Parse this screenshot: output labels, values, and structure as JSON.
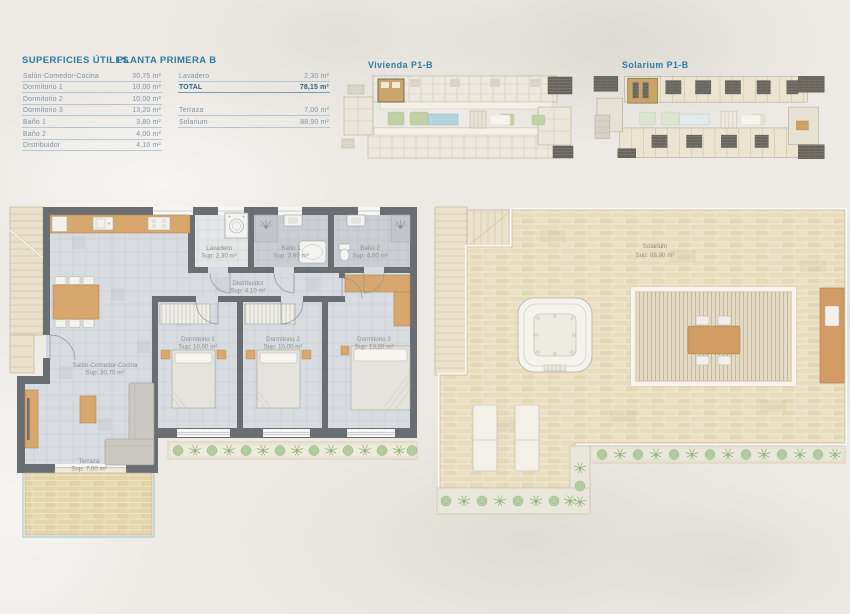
{
  "header": {
    "superficies_title": "SUPERFICIES ÚTILES",
    "planta_title": "PLANTA PRIMERA B"
  },
  "tables": {
    "left": {
      "rows": [
        {
          "label": "Salón-Comedor-Cocina",
          "value": "30,75 m²"
        },
        {
          "label": "Dormitorio 1",
          "value": "10,00 m²"
        },
        {
          "label": "Dormitorio 2",
          "value": "10,00 m²"
        },
        {
          "label": "Dormitorio 3",
          "value": "13,20 m²"
        },
        {
          "label": "Baño 1",
          "value": "3,80 m²"
        },
        {
          "label": "Baño 2",
          "value": "4,00 m²"
        },
        {
          "label": "Distribuidor",
          "value": "4,10 m²"
        }
      ]
    },
    "right": {
      "rows_top": [
        {
          "label": "Lavadero",
          "value": "2,30 m²"
        },
        {
          "label": "TOTAL",
          "value": "78,15 m²"
        }
      ],
      "rows_bottom": [
        {
          "label": "Terraza",
          "value": "7,00 m²"
        },
        {
          "label": "Solarium",
          "value": "88,90 m²"
        }
      ]
    }
  },
  "mini_plans": {
    "vivienda_label": "Vivienda P1-B",
    "solarium_label": "Solarium P1-B"
  },
  "floor_plan": {
    "rooms": {
      "lavadero": {
        "name": "Lavadero",
        "sup": "Sup: 2,30 m²"
      },
      "bano1": {
        "name": "Baño 1",
        "sup": "Sup: 3,80 m²"
      },
      "bano2": {
        "name": "Baño 2",
        "sup": "Sup: 4,00 m²"
      },
      "distribuidor": {
        "name": "Distribuidor",
        "sup": "Sup: 4,10 m²"
      },
      "dorm1": {
        "name": "Dormitorio 1",
        "sup": "Sup: 10,00 m²"
      },
      "dorm2": {
        "name": "Dormitorio 2",
        "sup": "Sup: 10,00 m²"
      },
      "dorm3": {
        "name": "Dormitorio 3",
        "sup": "Sup: 13,20 m²"
      },
      "salon": {
        "name": "Salón-Comedor-Cocina",
        "sup": "Sup: 30,75 m²"
      },
      "terraza": {
        "name": "Terraza",
        "sup": "Sup: 7,00 m²"
      }
    }
  },
  "solarium_plan": {
    "name": "Solarium",
    "sup": "Sup: 88,90 m²"
  },
  "colors": {
    "accent_teal": "#2b7aa1",
    "wall_gray": "#6a6d71",
    "wood": "#d7a76e",
    "pool_blue": "#b4d5e0",
    "plant_green": "#b7cda3",
    "terrace_beige": "#e4d4a8",
    "background": "#edeae5"
  }
}
